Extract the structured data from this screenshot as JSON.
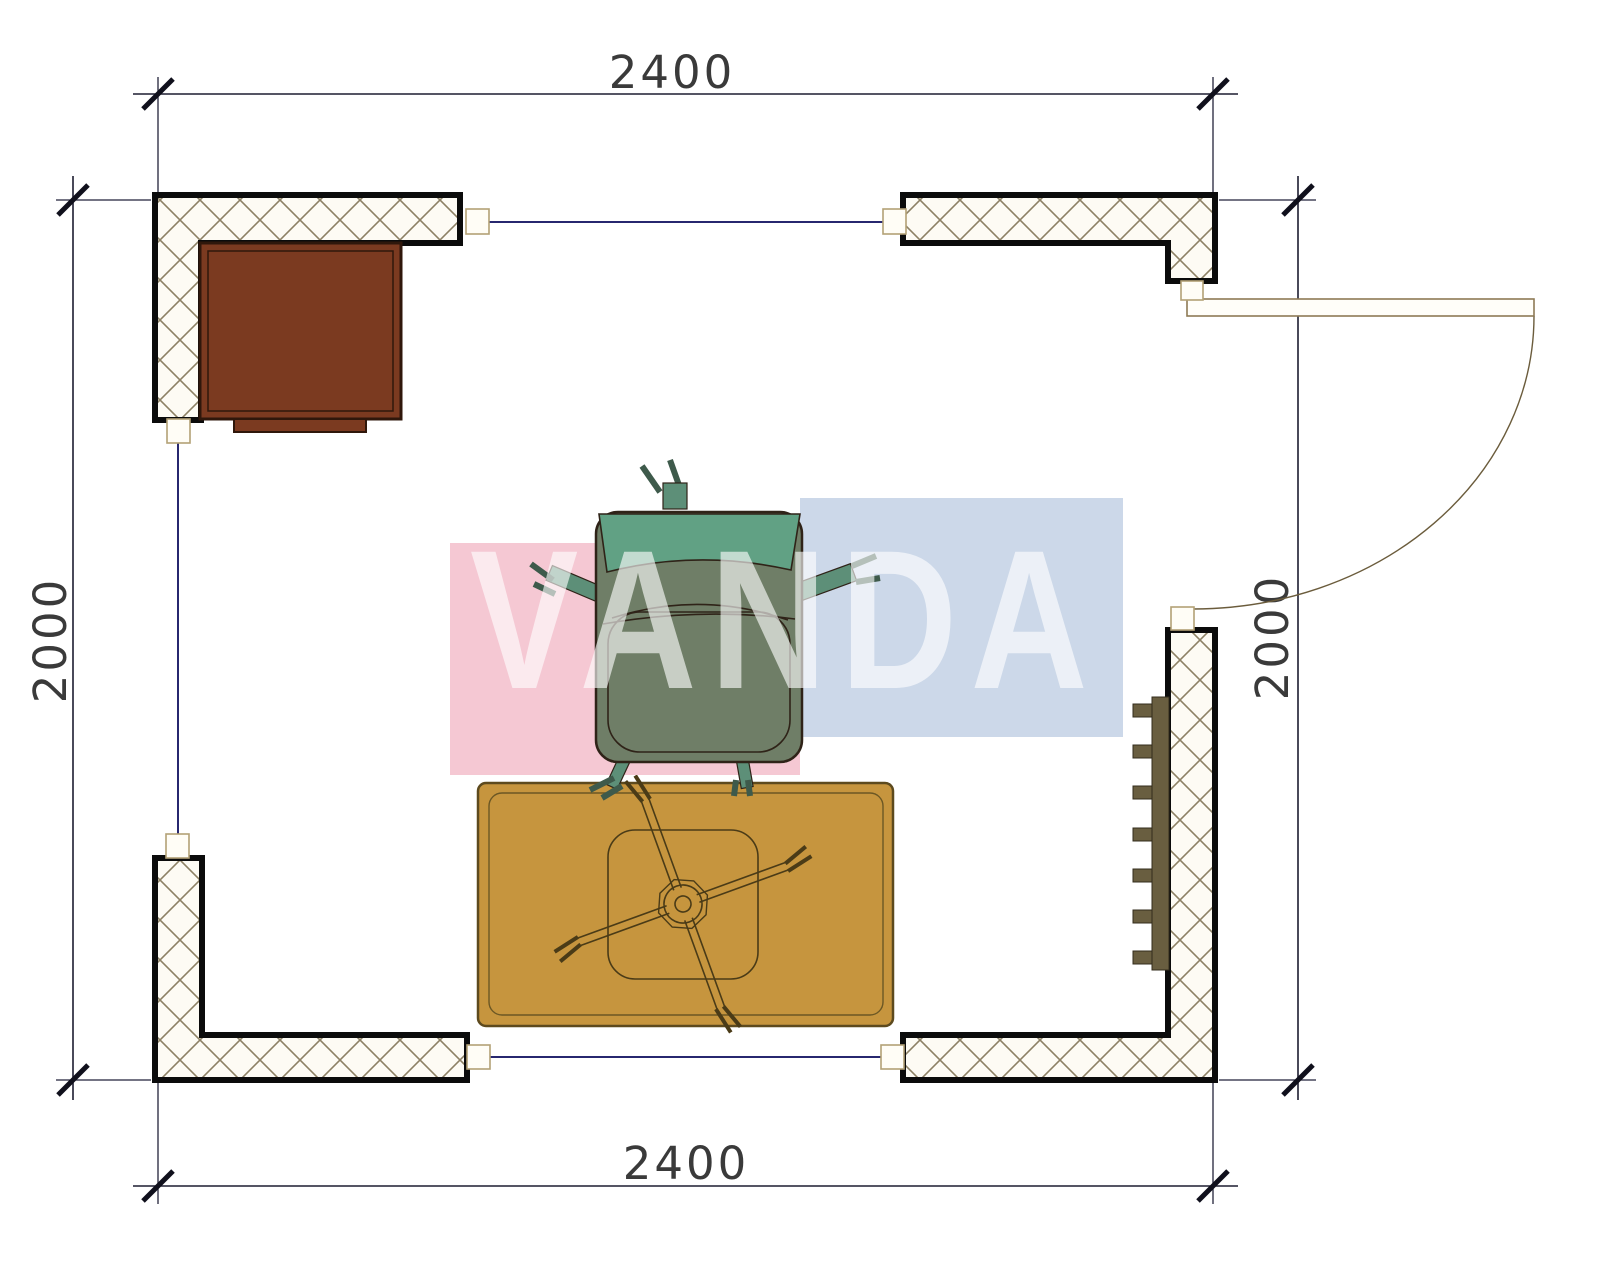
{
  "plan": {
    "watermark_text": "VANDA",
    "dim_top": "2400",
    "dim_bottom": "2400",
    "dim_left": "2000",
    "dim_right": "2000"
  },
  "colors": {
    "wall_stroke": "#0b0b0b",
    "hatch_line": "#8d8165",
    "hatch_bg": "#fdfbf4",
    "window_line": "#27276f",
    "dim_line": "#1d1d30",
    "dim_text": "#3a3a3a",
    "endcap_fill": "#fffdf6",
    "endcap_stroke": "#b3a176",
    "door_line": "#8d7a55",
    "cabinet": "#7b3a20",
    "rug": "#c6953e",
    "cross_line": "#4a3b17",
    "radiator": "#695e40",
    "chair_seat": "#6f7e67",
    "chair_back": "#61a184",
    "chair_limb": "#5d8f78",
    "watermark_pink": "#f5c8d3",
    "watermark_blue": "#ccd8e9",
    "watermark_letters": "rgba(255,255,255,0.62)"
  }
}
